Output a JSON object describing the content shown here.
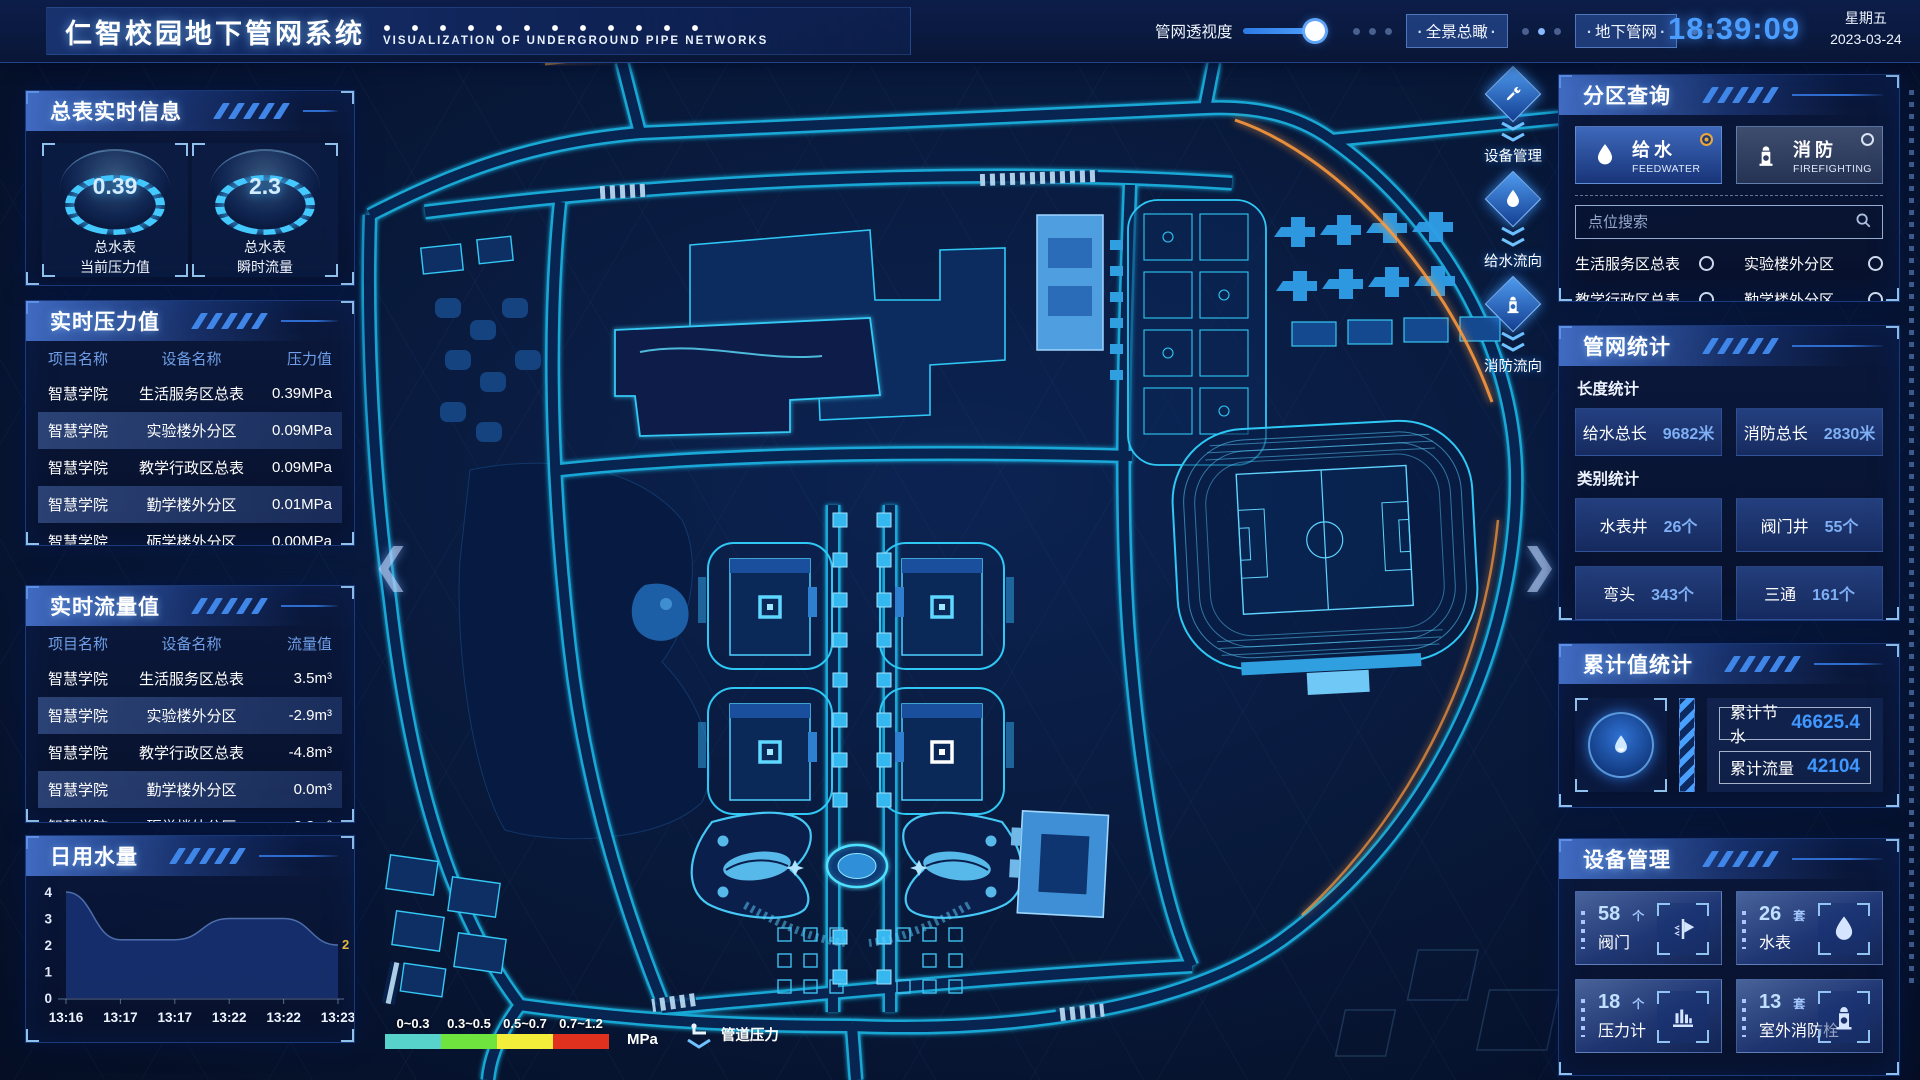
{
  "header": {
    "title": "仁智校园地下管网系统",
    "subtitle": "VISUALIZATION OF UNDERGROUND PIPE NETWORKS",
    "transparency_label": "管网透视度",
    "btn_panorama": "全景总瞰",
    "btn_underground": "地下管网",
    "time": "18:39:09",
    "weekday": "星期五",
    "date": "2023-03-24"
  },
  "left": {
    "master": {
      "title": "总表实时信息",
      "gauges": [
        {
          "value": "0.39",
          "caption1": "总水表",
          "caption2": "当前压力值"
        },
        {
          "value": "2.3",
          "caption1": "总水表",
          "caption2": "瞬时流量"
        }
      ]
    },
    "pressure": {
      "title": "实时压力值",
      "headers": [
        "项目名称",
        "设备名称",
        "压力值"
      ],
      "rows": [
        [
          "智慧学院",
          "生活服务区总表",
          "0.39MPa"
        ],
        [
          "智慧学院",
          "实验楼外分区",
          "0.09MPa"
        ],
        [
          "智慧学院",
          "教学行政区总表",
          "0.09MPa"
        ],
        [
          "智慧学院",
          "勤学楼外分区",
          "0.01MPa"
        ],
        [
          "智慧学院",
          "砺学楼外分区",
          "0.00MPa"
        ]
      ]
    },
    "flow": {
      "title": "实时流量值",
      "headers": [
        "项目名称",
        "设备名称",
        "流量值"
      ],
      "rows": [
        [
          "智慧学院",
          "生活服务区总表",
          "3.5m³"
        ],
        [
          "智慧学院",
          "实验楼外分区",
          "-2.9m³"
        ],
        [
          "智慧学院",
          "教学行政区总表",
          "-4.8m³"
        ],
        [
          "智慧学院",
          "勤学楼外分区",
          "0.0m³"
        ],
        [
          "智慧学院",
          "砺学楼外分区",
          "-2.3m³"
        ]
      ]
    },
    "daily": {
      "title": "日用水量",
      "chart_data": {
        "type": "area",
        "categories": [
          "13:16",
          "13:17",
          "13:17",
          "13:22",
          "13:22",
          "13:23"
        ],
        "values": [
          4,
          2.2,
          2.2,
          3,
          3,
          2
        ],
        "yticks": [
          0,
          1,
          2,
          3,
          4
        ],
        "ylim": [
          0,
          4
        ],
        "end_label": "2",
        "end_label_color": "#e8b93e",
        "grid": false,
        "title": "日用水量"
      }
    }
  },
  "map": {
    "rail": [
      {
        "label": "设备管理",
        "icon": "tools-icon"
      },
      {
        "label": "给水流向",
        "icon": "water-drop-icon"
      },
      {
        "label": "消防流向",
        "icon": "hydrant-icon"
      }
    ],
    "legend": {
      "ranges": [
        "0~0.3",
        "0.3~0.5",
        "0.5~0.7",
        "0.7~1.2"
      ],
      "colors": [
        "#57d3cc",
        "#6fe43e",
        "#f2ee3a",
        "#e0301e"
      ],
      "unit": "MPa",
      "pressure_label": "管道压力"
    }
  },
  "right": {
    "zone": {
      "title": "分区查询",
      "feedwater": {
        "label": "给水",
        "sub": "FEEDWATER"
      },
      "fire": {
        "label": "消防",
        "sub": "FIREFIGHTING"
      },
      "search_placeholder": "点位搜索",
      "items": [
        "生活服务区总表",
        "实验楼外分区",
        "教学行政区总表",
        "勤学楼外分区",
        "砺学楼外分区",
        "宿舍区泵房"
      ]
    },
    "network": {
      "title": "管网统计",
      "length_title": "长度统计",
      "length_stats": [
        {
          "label": "给水总长",
          "value": "9682米"
        },
        {
          "label": "消防总长",
          "value": "2830米"
        }
      ],
      "category_title": "类别统计",
      "category_stats": [
        {
          "label": "水表井",
          "value": "26个"
        },
        {
          "label": "阀门井",
          "value": "55个"
        },
        {
          "label": "弯头",
          "value": "343个"
        },
        {
          "label": "三通",
          "value": "161个"
        }
      ]
    },
    "cumulative": {
      "title": "累计值统计",
      "rows": [
        {
          "label": "累计节水",
          "value": "46625.4"
        },
        {
          "label": "累计流量",
          "value": "42104"
        }
      ]
    },
    "devices": {
      "title": "设备管理",
      "items": [
        {
          "count": "58",
          "unit": "个",
          "label": "阀门",
          "icon": "valve-icon"
        },
        {
          "count": "26",
          "unit": "套",
          "label": "水表",
          "icon": "water-drop-icon"
        },
        {
          "count": "18",
          "unit": "个",
          "label": "压力计",
          "icon": "pressure-gauge-icon"
        },
        {
          "count": "13",
          "unit": "套",
          "label": "室外消防栓",
          "icon": "hydrant-icon"
        }
      ]
    }
  }
}
